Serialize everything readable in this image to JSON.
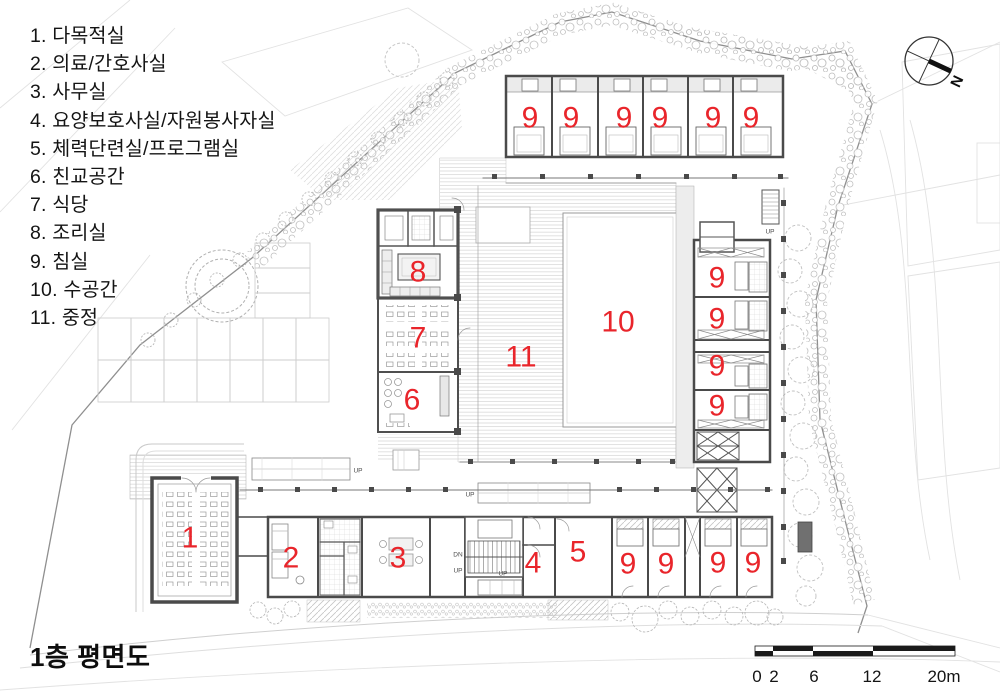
{
  "title": "1층 평면도",
  "legend": {
    "items": [
      {
        "no": "1",
        "name": "다목적실"
      },
      {
        "no": "2",
        "name": "의료/간호사실"
      },
      {
        "no": "3",
        "name": "사무실"
      },
      {
        "no": "4",
        "name": "요양보호사실/자원봉사자실"
      },
      {
        "no": "5",
        "name": "체력단련실/프로그램실"
      },
      {
        "no": "6",
        "name": "친교공간"
      },
      {
        "no": "7",
        "name": "식당"
      },
      {
        "no": "8",
        "name": "조리실"
      },
      {
        "no": "9",
        "name": "침실"
      },
      {
        "no": "10",
        "name": "수공간"
      },
      {
        "no": "11",
        "name": "중정"
      }
    ]
  },
  "compass": {
    "label": "N"
  },
  "scale_bar": {
    "ticks": [
      {
        "text": "0",
        "x": 757
      },
      {
        "text": "2",
        "x": 774
      },
      {
        "text": "6",
        "x": 814
      },
      {
        "text": "12",
        "x": 872
      },
      {
        "text": "20m",
        "x": 944
      }
    ]
  },
  "colors": {
    "room_number": "#e9252b",
    "wall": "#4a4a4a",
    "site_line": "#8f8f8f"
  },
  "plan": {
    "room_labels": [
      {
        "text": "9",
        "x": 530,
        "y": 117
      },
      {
        "text": "9",
        "x": 571,
        "y": 117
      },
      {
        "text": "9",
        "x": 624,
        "y": 117
      },
      {
        "text": "9",
        "x": 660,
        "y": 117
      },
      {
        "text": "9",
        "x": 713,
        "y": 117
      },
      {
        "text": "9",
        "x": 751,
        "y": 117
      },
      {
        "text": "8",
        "x": 418,
        "y": 271
      },
      {
        "text": "7",
        "x": 418,
        "y": 337
      },
      {
        "text": "6",
        "x": 412,
        "y": 399
      },
      {
        "text": "11",
        "x": 521,
        "y": 356
      },
      {
        "text": "10",
        "x": 618,
        "y": 321
      },
      {
        "text": "9",
        "x": 717,
        "y": 277
      },
      {
        "text": "9",
        "x": 717,
        "y": 318
      },
      {
        "text": "9",
        "x": 717,
        "y": 365
      },
      {
        "text": "9",
        "x": 717,
        "y": 405
      },
      {
        "text": "1",
        "x": 190,
        "y": 537
      },
      {
        "text": "2",
        "x": 291,
        "y": 557
      },
      {
        "text": "3",
        "x": 398,
        "y": 557
      },
      {
        "text": "4",
        "x": 533,
        "y": 562
      },
      {
        "text": "5",
        "x": 578,
        "y": 551
      },
      {
        "text": "9",
        "x": 628,
        "y": 563
      },
      {
        "text": "9",
        "x": 666,
        "y": 563
      },
      {
        "text": "9",
        "x": 718,
        "y": 562
      },
      {
        "text": "9",
        "x": 753,
        "y": 562
      }
    ],
    "annotations": [
      {
        "text": "UP",
        "x": 358,
        "y": 470
      },
      {
        "text": "UP",
        "x": 470,
        "y": 494
      },
      {
        "text": "UP",
        "x": 770,
        "y": 231
      },
      {
        "text": "DN",
        "x": 458,
        "y": 554
      },
      {
        "text": "UP",
        "x": 458,
        "y": 570
      },
      {
        "text": "UP",
        "x": 503,
        "y": 573
      }
    ]
  }
}
